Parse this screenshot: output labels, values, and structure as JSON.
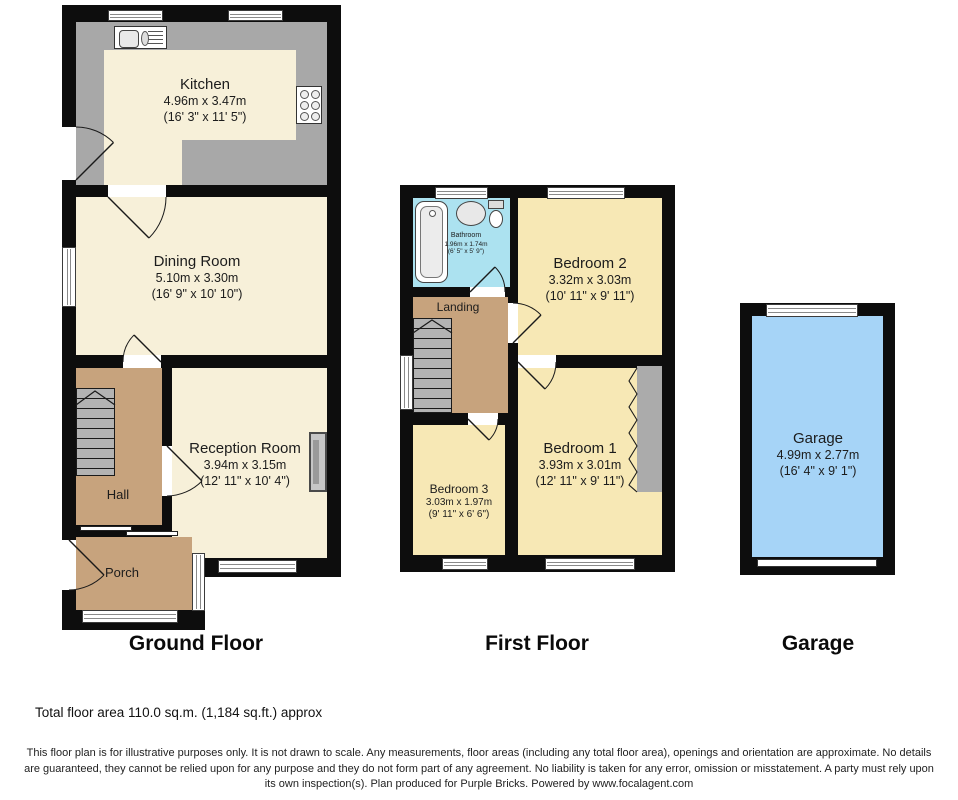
{
  "plans": {
    "ground_floor": {
      "label": "Ground Floor",
      "rooms": {
        "kitchen": {
          "name": "Kitchen",
          "metric": "4.96m x 3.47m",
          "imperial": "(16' 3\" x 11' 5\")"
        },
        "dining": {
          "name": "Dining Room",
          "metric": "5.10m x 3.30m",
          "imperial": "(16' 9\" x 10' 10\")"
        },
        "reception": {
          "name": "Reception Room",
          "metric": "3.94m x 3.15m",
          "imperial": "(12' 11\" x 10' 4\")"
        },
        "hall": {
          "name": "Hall"
        },
        "porch": {
          "name": "Porch"
        }
      }
    },
    "first_floor": {
      "label": "First Floor",
      "rooms": {
        "bathroom": {
          "name": "Bathroom",
          "metric": "1.96m x 1.74m",
          "imperial": "(6' 5\" x 5' 9\")"
        },
        "bedroom2": {
          "name": "Bedroom 2",
          "metric": "3.32m x 3.03m",
          "imperial": "(10' 11\" x 9' 11\")"
        },
        "landing": {
          "name": "Landing"
        },
        "bedroom3": {
          "name": "Bedroom 3",
          "metric": "3.03m x 1.97m",
          "imperial": "(9' 11\" x 6' 6\")"
        },
        "bedroom1": {
          "name": "Bedroom 1",
          "metric": "3.93m x 3.01m",
          "imperial": "(12' 11\" x 9' 11\")"
        }
      }
    },
    "garage": {
      "label": "Garage",
      "rooms": {
        "garage": {
          "name": "Garage",
          "metric": "4.99m x 2.77m",
          "imperial": "(16' 4\" x 9' 1\")"
        }
      }
    }
  },
  "footer": {
    "total_area": "Total floor area 110.0 sq.m. (1,184 sq.ft.) approx",
    "disclaimer": "This floor plan is for illustrative purposes only. It is not drawn to scale. Any measurements, floor areas (including any total floor area), openings and orientation are approximate. No details are guaranteed, they cannot be relied upon for any purpose and they do not form part of any agreement. No liability is taken for any error, omission or misstatement. A party must rely upon its own inspection(s). Plan produced for Purple Bricks. Powered by www.focalagent.com"
  },
  "colors": {
    "wall": "#0d0d0d",
    "room_cream": "#f7f0d9",
    "room_yellow": "#f7e8b5",
    "room_tan": "#c7a37d",
    "bathroom_blue": "#ace2f0",
    "garage_blue": "#a6d4f7",
    "counter_gray": "#a8a8a8",
    "stairs_gray": "#b3b3b3"
  }
}
